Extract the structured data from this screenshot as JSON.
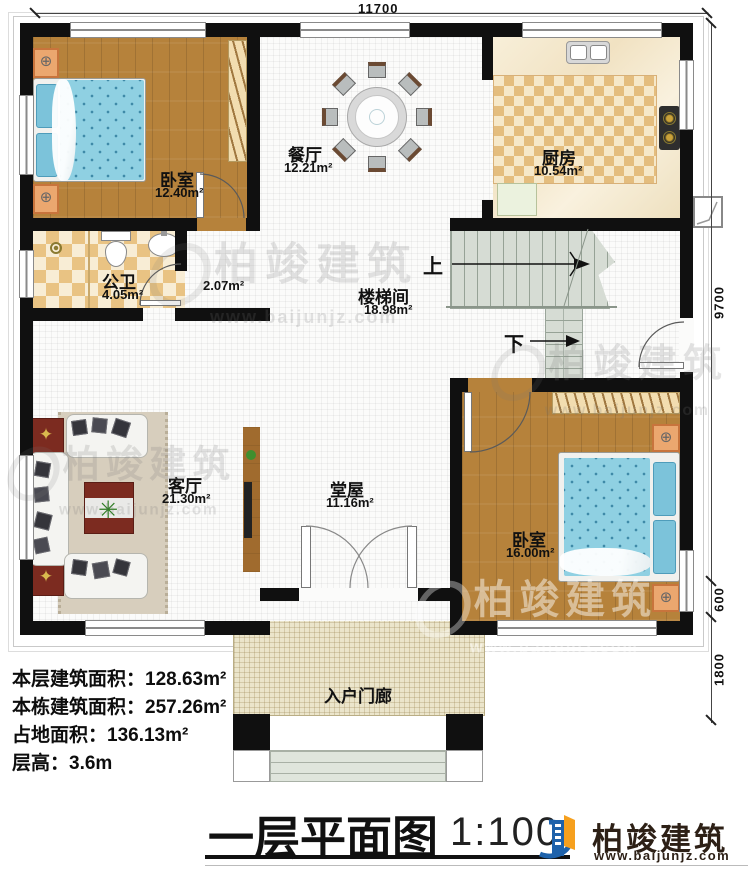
{
  "dimensions": {
    "width_top": "11700",
    "height_right": "9700",
    "bay_right": "600",
    "porch_right": "1800"
  },
  "rooms": {
    "bedroom1": {
      "name": "卧室",
      "area": "12.40m²"
    },
    "dining": {
      "name": "餐厅",
      "area": "12.21m²"
    },
    "kitchen": {
      "name": "厨房",
      "area": "10.54m²"
    },
    "bathroom": {
      "name": "公卫",
      "area": "4.05m²"
    },
    "vestibule": {
      "area": "2.07m²"
    },
    "stair_hall": {
      "name": "楼梯间",
      "area": "18.98m²"
    },
    "living": {
      "name": "客厅",
      "area": "21.30m²"
    },
    "hall": {
      "name": "堂屋",
      "area": "11.16m²"
    },
    "bedroom2": {
      "name": "卧室",
      "area": "16.00m²"
    },
    "porch": {
      "name": "入户门廊"
    }
  },
  "stairs": {
    "up": "上",
    "down": "下"
  },
  "stats": {
    "line1": "本层建筑面积：128.63m²",
    "line2": "本栋建筑面积：257.26m²",
    "line3": "占地面积：136.13m²",
    "line4": "层高：3.6m"
  },
  "title": {
    "name": "一层平面图",
    "scale": "1:100"
  },
  "brand": {
    "name": "柏竣建筑",
    "url": "www.baijunjz.com"
  },
  "watermark": {
    "name": "柏竣建筑",
    "url": "www.baijunjz.com"
  },
  "colors": {
    "wall": "#101010",
    "wood": "#b6823b",
    "mattress": "#8fd0e2",
    "logo_blue": "#1e62ab",
    "logo_orange": "#f6a01e"
  }
}
